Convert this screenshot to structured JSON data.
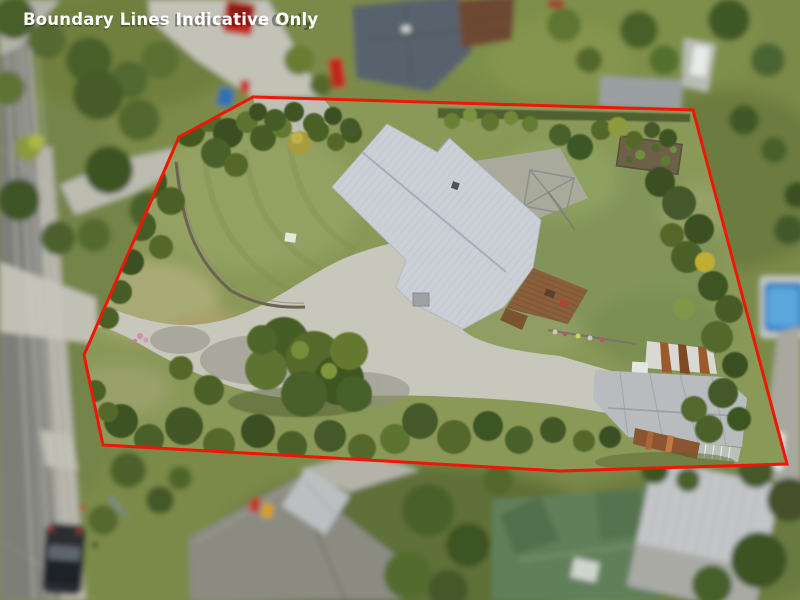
{
  "watermark": {
    "text": "Boundary Lines Indicative Only",
    "color": "#ffffff"
  },
  "boundary": {
    "label": "indicative property boundary outline",
    "color": "#f01507",
    "points": "253,97 693,110 787,464 560,471 350,459 103,445 84,355 179,137"
  },
  "scene": {
    "type": "aerial drone photograph",
    "subject": "residential section outlined in red with house, curved driveway, lawns and outbuildings",
    "palette": {
      "lawn": "#8a9858",
      "lawn_dry": "#a8aa74",
      "tree_dark": "#3f5522",
      "tree_light": "#6d8134",
      "driveway_concrete": "#c8c7bb",
      "house_roof": "#cbcfd6",
      "deck_timber": "#8a5f3c",
      "garage_roof": "#b9bcbf",
      "garage_rust": "#90582c",
      "road_asphalt": "#8a8a84",
      "pool_water": "#3a86c8",
      "boundary_red": "#f01507"
    },
    "features": [
      "main house with light grey corrugated roof",
      "timber deck on south-east corner of house",
      "curved concrete driveway from street",
      "large front lawn with curved retaining wall",
      "concrete pad with rotary clothesline",
      "raised vegetable garden bed",
      "garage with rusted lean-to and glasshouse",
      "mature trees along all boundaries",
      "street with footpath, power lines and parked car",
      "neighbouring houses, sheds and pool outside boundary"
    ]
  }
}
